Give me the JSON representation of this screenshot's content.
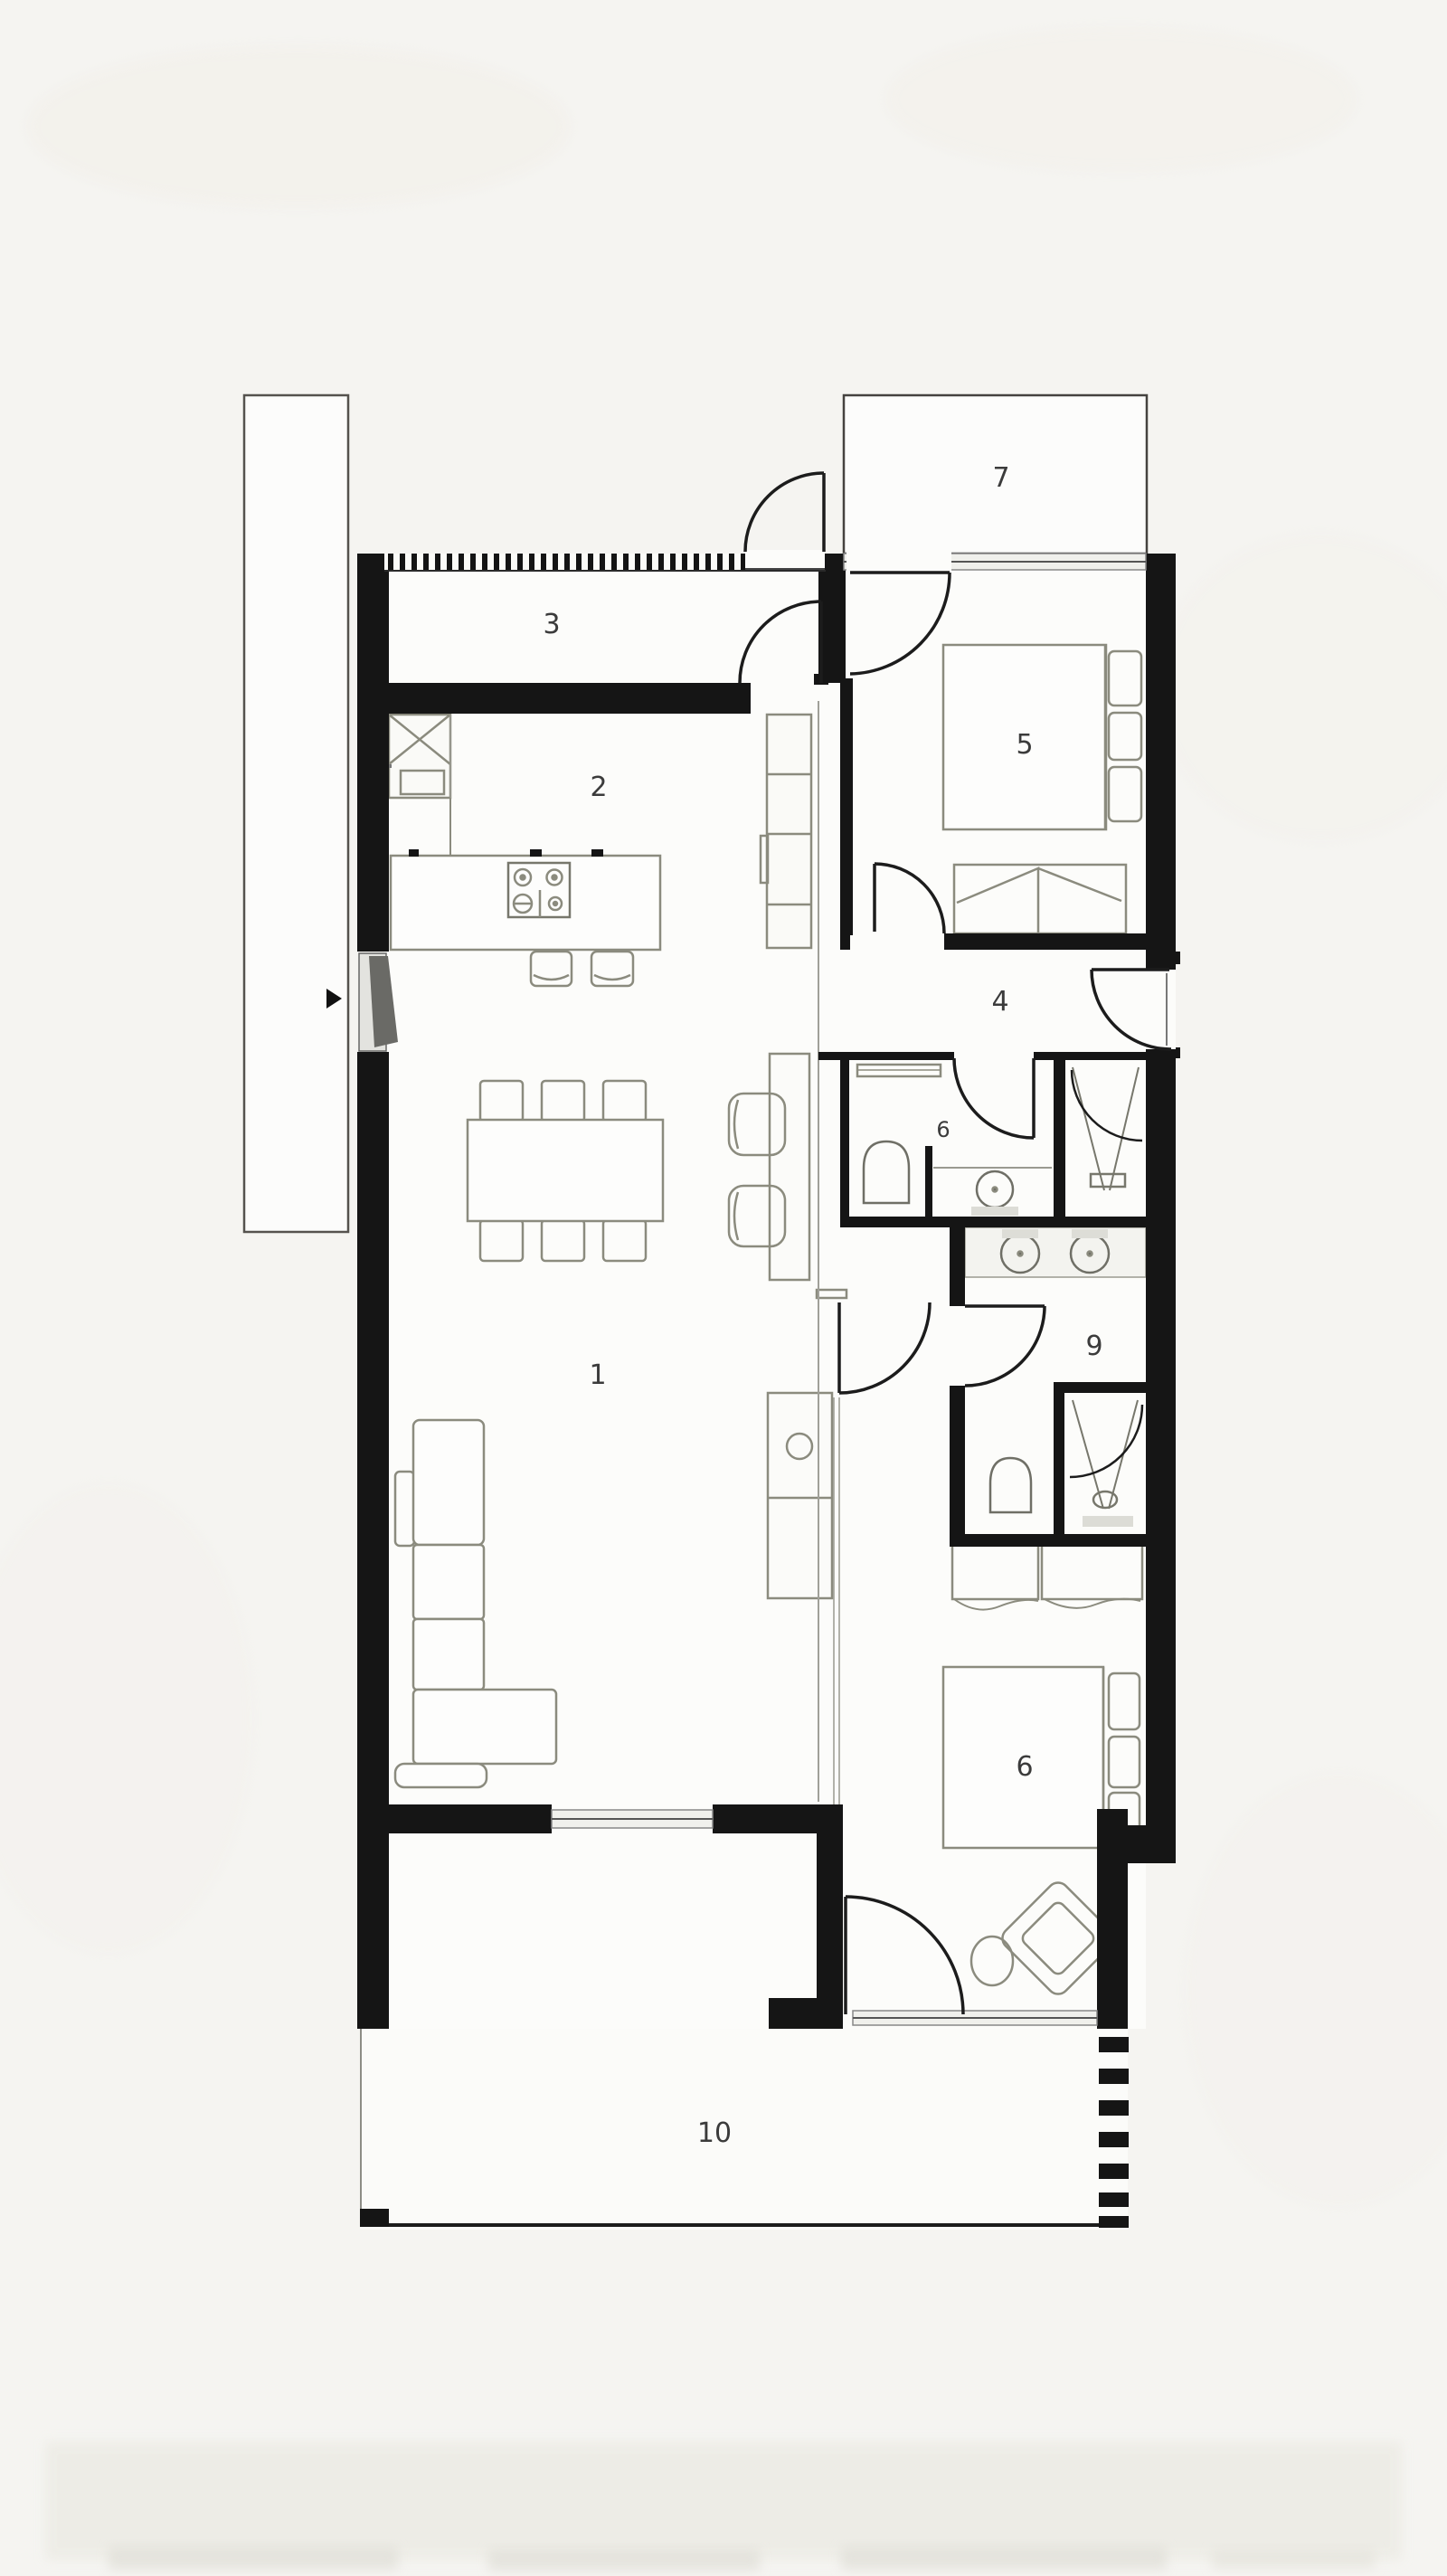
{
  "floorplan": {
    "rooms": [
      {
        "name": "living-dining",
        "label": "1"
      },
      {
        "name": "kitchen",
        "label": "2"
      },
      {
        "name": "entry-hall",
        "label": "3"
      },
      {
        "name": "hallway",
        "label": "4"
      },
      {
        "name": "bedroom-upper",
        "label": "5"
      },
      {
        "name": "bathroom",
        "label": "6"
      },
      {
        "name": "balcony",
        "label": "7"
      },
      {
        "name": "bedroom-lower",
        "label": "6"
      },
      {
        "name": "ensuite-bathroom",
        "label": "9"
      },
      {
        "name": "terrace",
        "label": "10"
      }
    ],
    "colors": {
      "wall": "#151515",
      "furniture_line": "#8b8b7e",
      "window_fill": "#f0f0ec",
      "floor": "#fcfcfa",
      "background": "#f5f4f1",
      "label": "#3b3b3b"
    }
  }
}
